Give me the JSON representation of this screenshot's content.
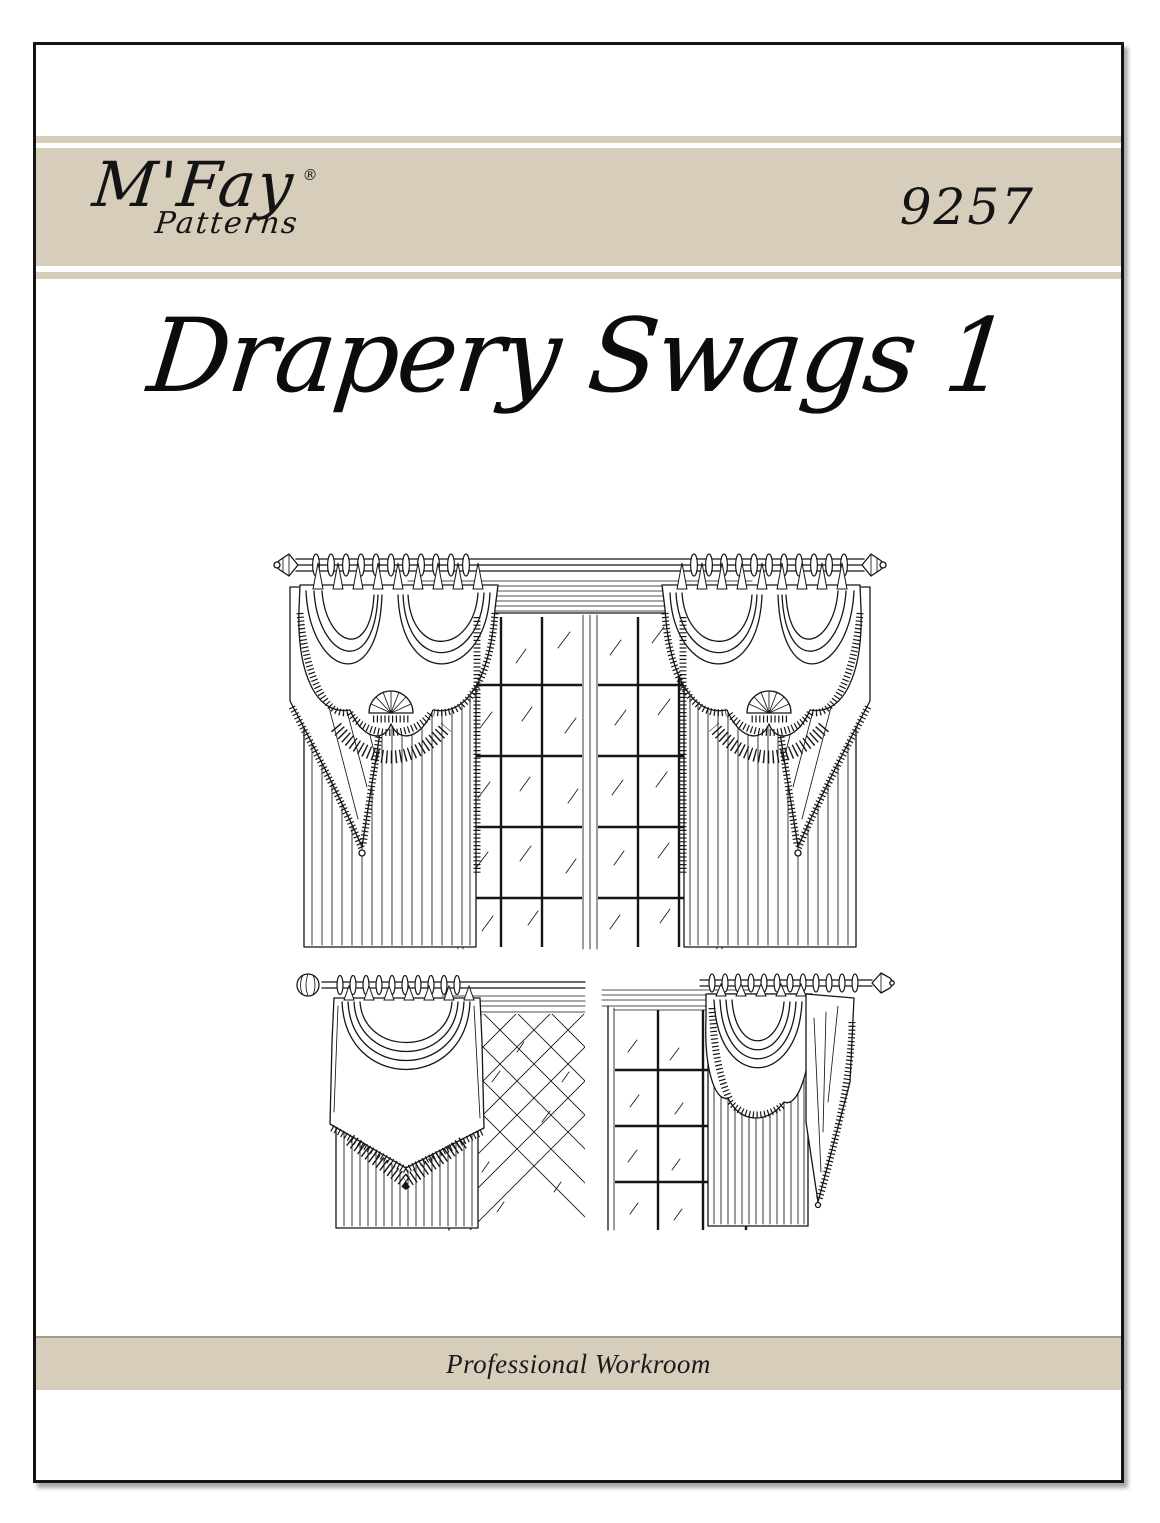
{
  "page": {
    "background": "#ffffff",
    "frame_color": "#151515",
    "ink": "#161616"
  },
  "banner": {
    "background": "#d6cebb",
    "brand": "M'Fay",
    "registered_mark": "®",
    "brand_sub": "Patterns",
    "pattern_number": "9257"
  },
  "title": {
    "text": "Drapery Swags 1"
  },
  "illustrations": {
    "main": "double window with two fringed swag valances, cascades and floor-length panels on a ringed rod",
    "bottom_left": "fringed swag valance and panel beside diamond-lattice window, ball finial rod",
    "bottom_right": "fringed swag valance with side cascade beside grid-pane window"
  },
  "footer": {
    "text": "Professional Workroom",
    "background": "#d6cebb"
  }
}
